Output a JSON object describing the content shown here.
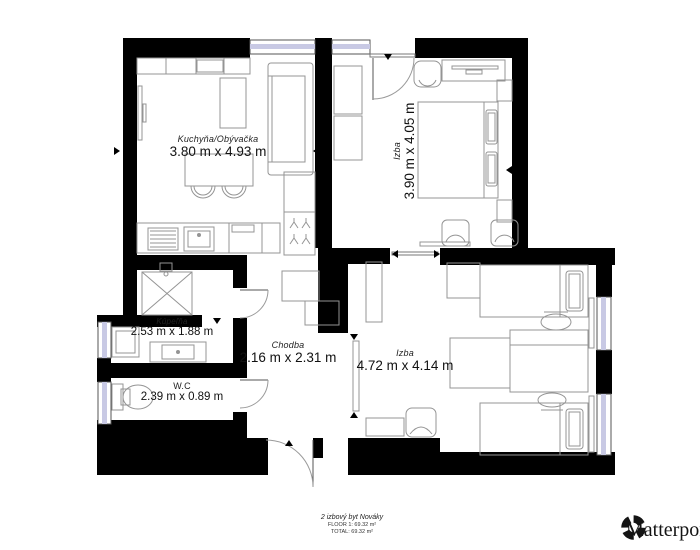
{
  "rooms": {
    "kitchen_living": {
      "name": "Kuchyňa/Obývačka",
      "dims": "3.80 m x 4.93 m"
    },
    "bedroom_top": {
      "name": "Izba",
      "dims": "3.90 m x 4.05 m"
    },
    "bathroom": {
      "name": "Kúpeľňa",
      "dims": "2.53 m x 1.88 m"
    },
    "wc": {
      "name": "W.C",
      "dims": "2.39 m x 0.89 m"
    },
    "hallway": {
      "name": "Chodba",
      "dims": "2.16 m x 2.31 m"
    },
    "bedroom_bottom": {
      "name": "Izba",
      "dims": "4.72 m x 4.14 m"
    }
  },
  "footer": {
    "plan_title": "2 izbový byt Nováky",
    "floor_line": "FLOOR 1: 69.32 m²",
    "total_line": "TOTAL: 69.32 m²"
  },
  "branding": {
    "logo_text": "Matterport",
    "logo_icon": "matterport-pinwheel-icon"
  },
  "colors": {
    "wall": "#000000",
    "furniture_outline": "#949494",
    "window_tint": "#c8c9e4",
    "background": "#ffffff",
    "text": "#111111"
  }
}
